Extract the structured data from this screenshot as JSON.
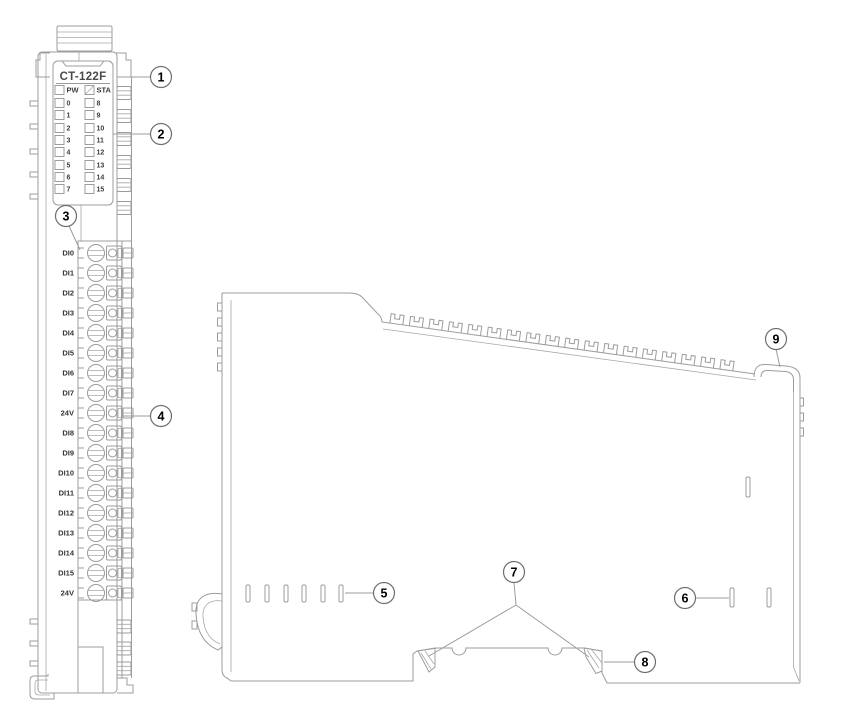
{
  "diagram": {
    "front_view": {
      "model_label": "CT-122F",
      "led_header": {
        "power": "PW",
        "status": "STA"
      },
      "led_channels_left": [
        "0",
        "1",
        "2",
        "3",
        "4",
        "5",
        "6",
        "7"
      ],
      "led_channels_right": [
        "8",
        "9",
        "10",
        "11",
        "12",
        "13",
        "14",
        "15"
      ],
      "terminal_labels": [
        "DI0",
        "DI1",
        "DI2",
        "DI3",
        "DI4",
        "DI5",
        "DI6",
        "DI7",
        "24V",
        "DI8",
        "DI9",
        "DI10",
        "DI11",
        "DI12",
        "DI13",
        "DI14",
        "DI15",
        "24V"
      ]
    },
    "callout_numbers": [
      "1",
      "2",
      "3",
      "4",
      "5",
      "6",
      "7",
      "8",
      "9"
    ],
    "colors": {
      "line": "#9c9c9c",
      "label_text": "#3d3d3d",
      "callout_text": "#000000",
      "background": "#ffffff"
    }
  }
}
